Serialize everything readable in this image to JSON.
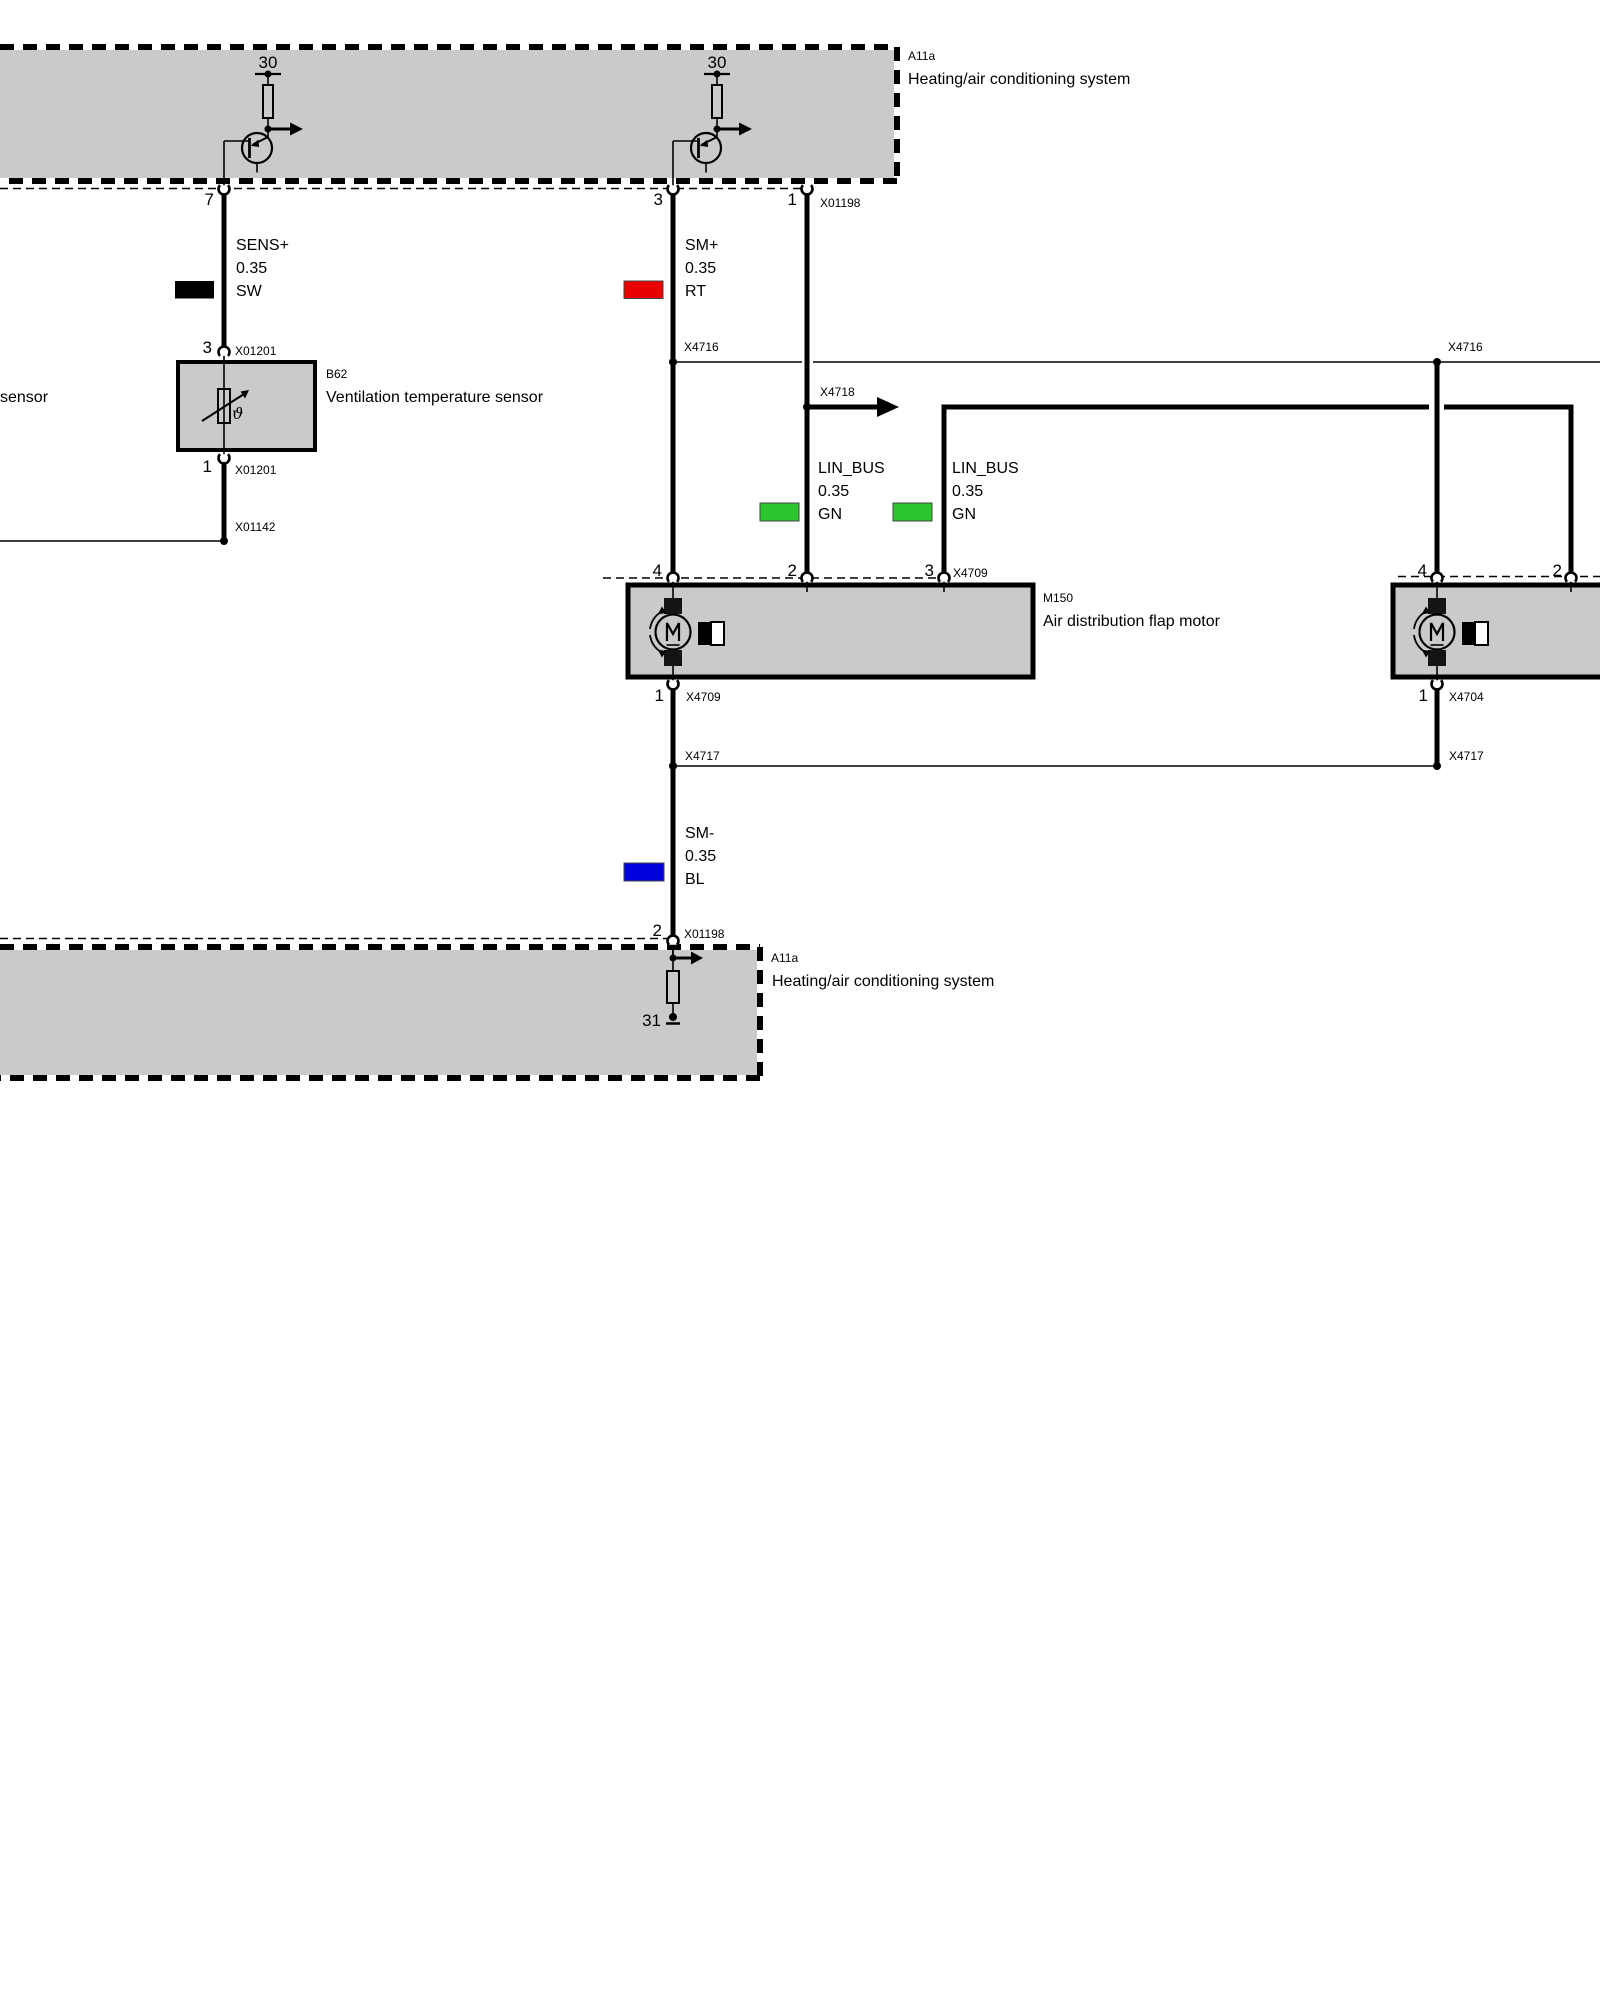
{
  "colors": {
    "black": "#000000",
    "red": "#e60000",
    "green": "#2ec62e",
    "blue": "#0000dc",
    "box_gray": "#cacaca"
  },
  "top_box": {
    "code": "A11a",
    "name": "Heating/air conditioning system",
    "terminal_left": "30",
    "terminal_right": "30",
    "pin7": "7",
    "pin3": "3",
    "pin1": "1",
    "connector": "X01198"
  },
  "sensor": {
    "partial_left_text": "sensor",
    "pin_top": "3",
    "connector_top": "X01201",
    "code": "B62",
    "name": "Ventilation temperature sensor",
    "symbol": "ϑ",
    "pin_bottom": "1",
    "connector_bottom": "X01201",
    "ground_splice": "X01142"
  },
  "wires": {
    "sens_plus": {
      "signal": "SENS+",
      "size": "0.35",
      "color": "SW"
    },
    "sm_plus": {
      "signal": "SM+",
      "size": "0.35",
      "color": "RT"
    },
    "lin_bus_left": {
      "signal": "LIN_BUS",
      "size": "0.35",
      "color": "GN"
    },
    "lin_bus_right": {
      "signal": "LIN_BUS",
      "size": "0.35",
      "color": "GN"
    },
    "sm_minus": {
      "signal": "SM-",
      "size": "0.35",
      "color": "BL"
    }
  },
  "connectors": {
    "x4716_left": "X4716",
    "x4716_right": "X4716",
    "x4718": "X4718",
    "x4717_left": "X4717",
    "x4717_right": "X4717"
  },
  "motor_left": {
    "pin4": "4",
    "pin2": "2",
    "pin3": "3",
    "pin1": "1",
    "connector_top": "X4709",
    "connector_bottom": "X4709",
    "code": "M150",
    "name": "Air distribution flap motor"
  },
  "motor_right": {
    "pin4": "4",
    "pin2": "2",
    "pin1": "1",
    "connector_bottom": "X4704"
  },
  "bottom_box": {
    "pin2": "2",
    "connector": "X01198",
    "code": "A11a",
    "name": "Heating/air conditioning system",
    "terminal": "31"
  }
}
